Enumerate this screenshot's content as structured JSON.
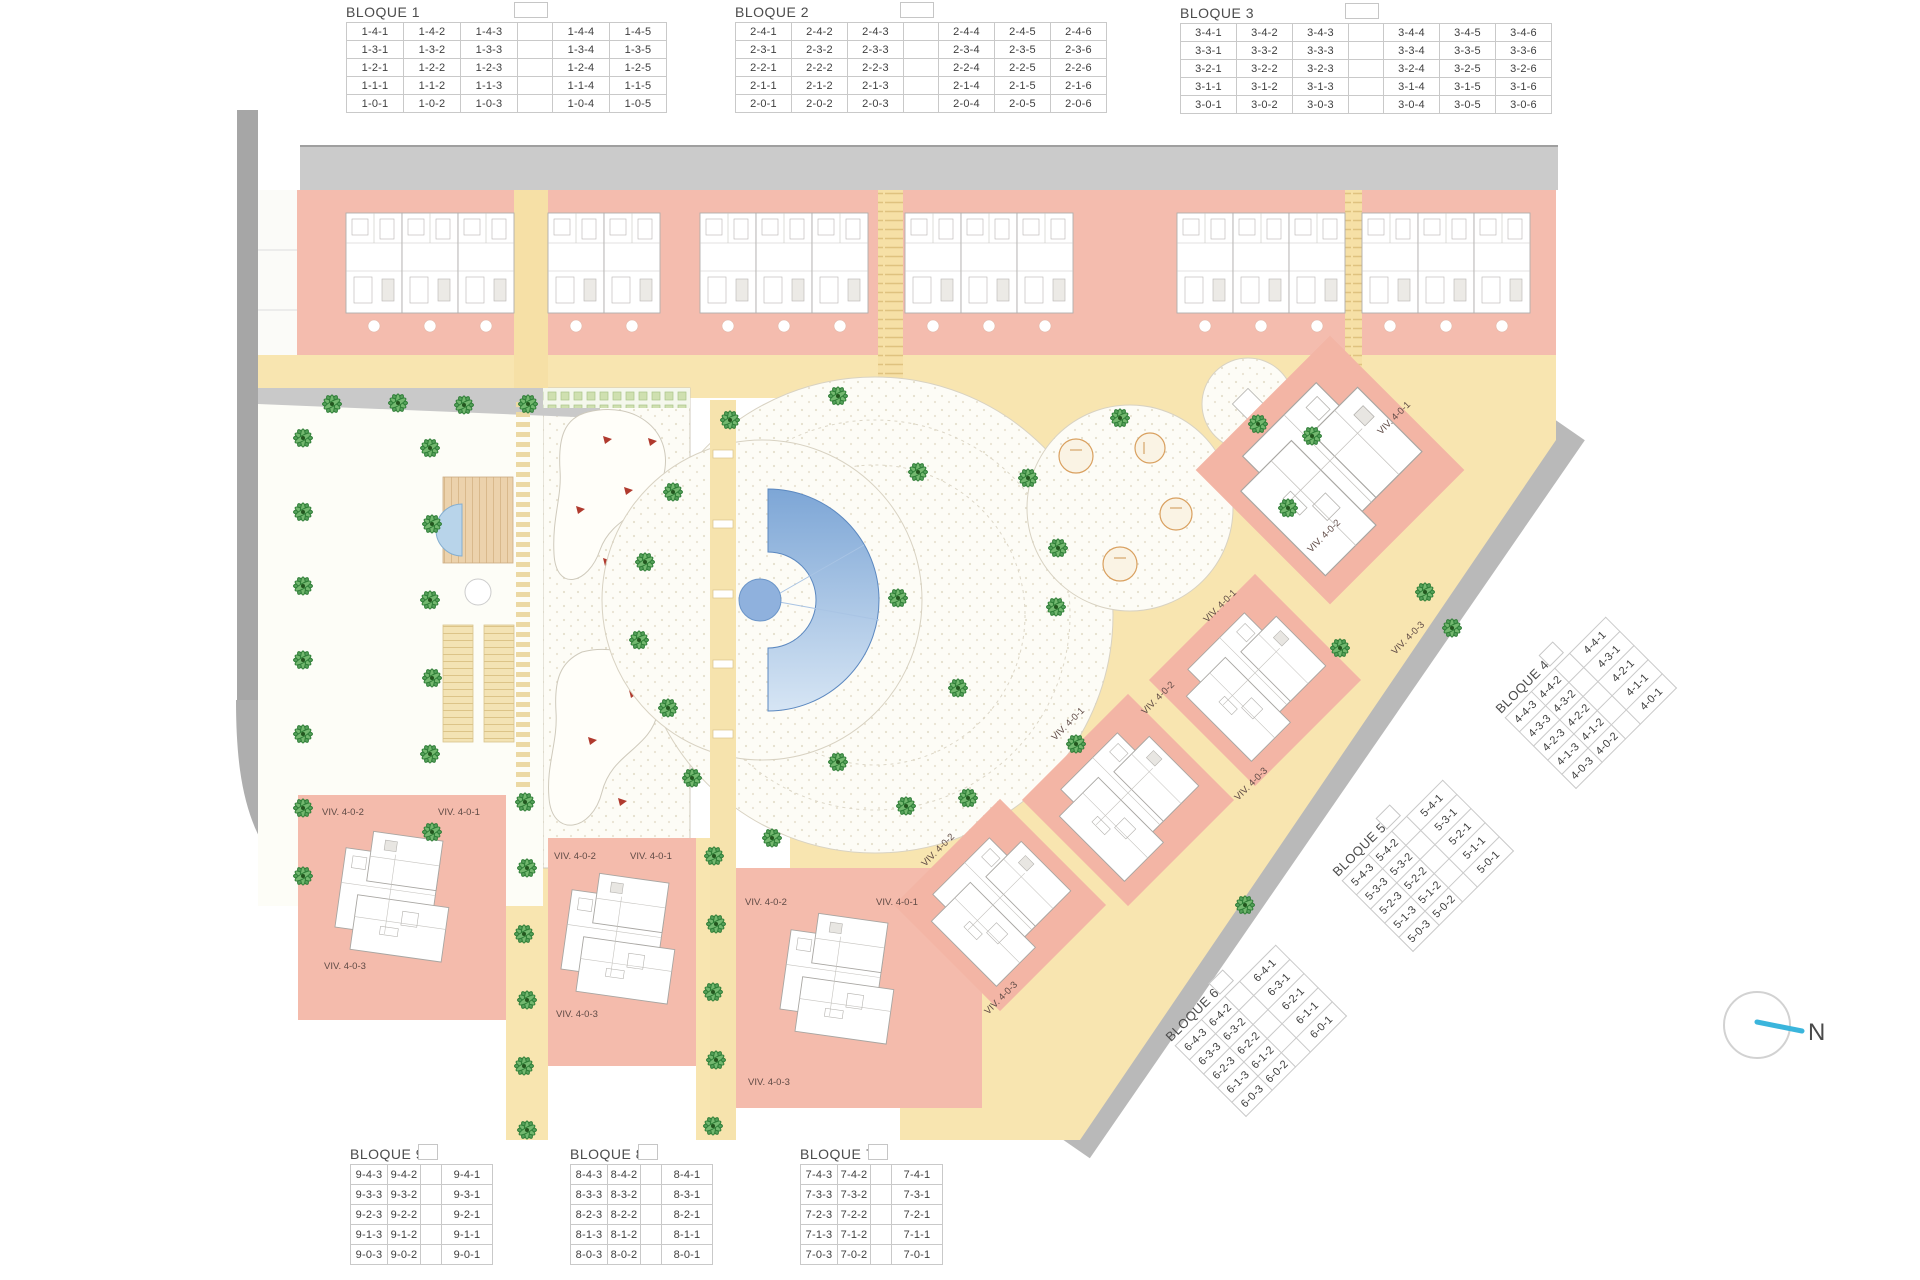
{
  "bloques": [
    {
      "title": "BLOQUE 1",
      "gap_after": 3,
      "col_widths": [
        56,
        56,
        56,
        34,
        56,
        56
      ],
      "row_h": 19,
      "rows": [
        [
          "1-4-1",
          "1-4-2",
          "1-4-3",
          "1-4-4",
          "1-4-5"
        ],
        [
          "1-3-1",
          "1-3-2",
          "1-3-3",
          "1-3-4",
          "1-3-5"
        ],
        [
          "1-2-1",
          "1-2-2",
          "1-2-3",
          "1-2-4",
          "1-2-5"
        ],
        [
          "1-1-1",
          "1-1-2",
          "1-1-3",
          "1-1-4",
          "1-1-5"
        ],
        [
          "1-0-1",
          "1-0-2",
          "1-0-3",
          "1-0-4",
          "1-0-5"
        ]
      ]
    },
    {
      "title": "BLOQUE 2",
      "gap_after": 3,
      "col_widths": [
        55,
        55,
        55,
        34,
        55,
        55,
        55
      ],
      "row_h": 19,
      "rows": [
        [
          "2-4-1",
          "2-4-2",
          "2-4-3",
          "2-4-4",
          "2-4-5",
          "2-4-6"
        ],
        [
          "2-3-1",
          "2-3-2",
          "2-3-3",
          "2-3-4",
          "2-3-5",
          "2-3-6"
        ],
        [
          "2-2-1",
          "2-2-2",
          "2-2-3",
          "2-2-4",
          "2-2-5",
          "2-2-6"
        ],
        [
          "2-1-1",
          "2-1-2",
          "2-1-3",
          "2-1-4",
          "2-1-5",
          "2-1-6"
        ],
        [
          "2-0-1",
          "2-0-2",
          "2-0-3",
          "2-0-4",
          "2-0-5",
          "2-0-6"
        ]
      ]
    },
    {
      "title": "BLOQUE 3",
      "gap_after": 3,
      "col_widths": [
        55,
        55,
        55,
        34,
        55,
        55,
        55
      ],
      "row_h": 19,
      "rows": [
        [
          "3-4-1",
          "3-4-2",
          "3-4-3",
          "3-4-4",
          "3-4-5",
          "3-4-6"
        ],
        [
          "3-3-1",
          "3-3-2",
          "3-3-3",
          "3-3-4",
          "3-3-5",
          "3-3-6"
        ],
        [
          "3-2-1",
          "3-2-2",
          "3-2-3",
          "3-2-4",
          "3-2-5",
          "3-2-6"
        ],
        [
          "3-1-1",
          "3-1-2",
          "3-1-3",
          "3-1-4",
          "3-1-5",
          "3-1-6"
        ],
        [
          "3-0-1",
          "3-0-2",
          "3-0-3",
          "3-0-4",
          "3-0-5",
          "3-0-6"
        ]
      ]
    },
    {
      "title": "BLOQUE 4",
      "gap_after": 2,
      "col_widths": [
        36,
        32,
        20,
        50
      ],
      "row_h": 21,
      "rows": [
        [
          "4-4-3",
          "4-4-2",
          "4-4-1"
        ],
        [
          "4-3-3",
          "4-3-2",
          "4-3-1"
        ],
        [
          "4-2-3",
          "4-2-2",
          "4-2-1"
        ],
        [
          "4-1-3",
          "4-1-2",
          "4-1-1"
        ],
        [
          "4-0-3",
          "4-0-2",
          "4-0-1"
        ]
      ]
    },
    {
      "title": "BLOQUE 5",
      "gap_after": 2,
      "col_widths": [
        36,
        32,
        20,
        50
      ],
      "row_h": 21,
      "rows": [
        [
          "5-4-3",
          "5-4-2",
          "5-4-1"
        ],
        [
          "5-3-3",
          "5-3-2",
          "5-3-1"
        ],
        [
          "5-2-3",
          "5-2-2",
          "5-2-1"
        ],
        [
          "5-1-3",
          "5-1-2",
          "5-1-1"
        ],
        [
          "5-0-3",
          "5-0-2",
          "5-0-1"
        ]
      ]
    },
    {
      "title": "BLOQUE 6",
      "gap_after": 2,
      "col_widths": [
        36,
        32,
        20,
        50
      ],
      "row_h": 21,
      "rows": [
        [
          "6-4-3",
          "6-4-2",
          "6-4-1"
        ],
        [
          "6-3-3",
          "6-3-2",
          "6-3-1"
        ],
        [
          "6-2-3",
          "6-2-2",
          "6-2-1"
        ],
        [
          "6-1-3",
          "6-1-2",
          "6-1-1"
        ],
        [
          "6-0-3",
          "6-0-2",
          "6-0-1"
        ]
      ]
    },
    {
      "title": "BLOQUE 7",
      "gap_after": 2,
      "col_widths": [
        36,
        32,
        20,
        50
      ],
      "row_h": 21,
      "rows": [
        [
          "7-4-3",
          "7-4-2",
          "7-4-1"
        ],
        [
          "7-3-3",
          "7-3-2",
          "7-3-1"
        ],
        [
          "7-2-3",
          "7-2-2",
          "7-2-1"
        ],
        [
          "7-1-3",
          "7-1-2",
          "7-1-1"
        ],
        [
          "7-0-3",
          "7-0-2",
          "7-0-1"
        ]
      ]
    },
    {
      "title": "BLOQUE 8",
      "gap_after": 2,
      "col_widths": [
        36,
        32,
        20,
        50
      ],
      "row_h": 21,
      "rows": [
        [
          "8-4-3",
          "8-4-2",
          "8-4-1"
        ],
        [
          "8-3-3",
          "8-3-2",
          "8-3-1"
        ],
        [
          "8-2-3",
          "8-2-2",
          "8-2-1"
        ],
        [
          "8-1-3",
          "8-1-2",
          "8-1-1"
        ],
        [
          "8-0-3",
          "8-0-2",
          "8-0-1"
        ]
      ]
    },
    {
      "title": "BLOQUE 9",
      "gap_after": 2,
      "col_widths": [
        36,
        32,
        20,
        50
      ],
      "row_h": 21,
      "rows": [
        [
          "9-4-3",
          "9-4-2",
          "9-4-1"
        ],
        [
          "9-3-3",
          "9-3-2",
          "9-3-1"
        ],
        [
          "9-2-3",
          "9-2-2",
          "9-2-1"
        ],
        [
          "9-1-3",
          "9-1-2",
          "9-1-1"
        ],
        [
          "9-0-3",
          "9-0-2",
          "9-0-1"
        ]
      ]
    }
  ],
  "plan": {
    "viv": [
      "VIV. 4-0-1",
      "VIV. 4-0-2",
      "VIV. 4-0-3"
    ],
    "north": "N",
    "colors": {
      "building_pink": "#f4bbac",
      "path_yellow": "#f8e5b0",
      "road_gray": "#c9c9c9",
      "pool_blue": "#7da6d6",
      "palm_green": "#55a05a",
      "plaza_cream": "#fdfcf6"
    }
  }
}
